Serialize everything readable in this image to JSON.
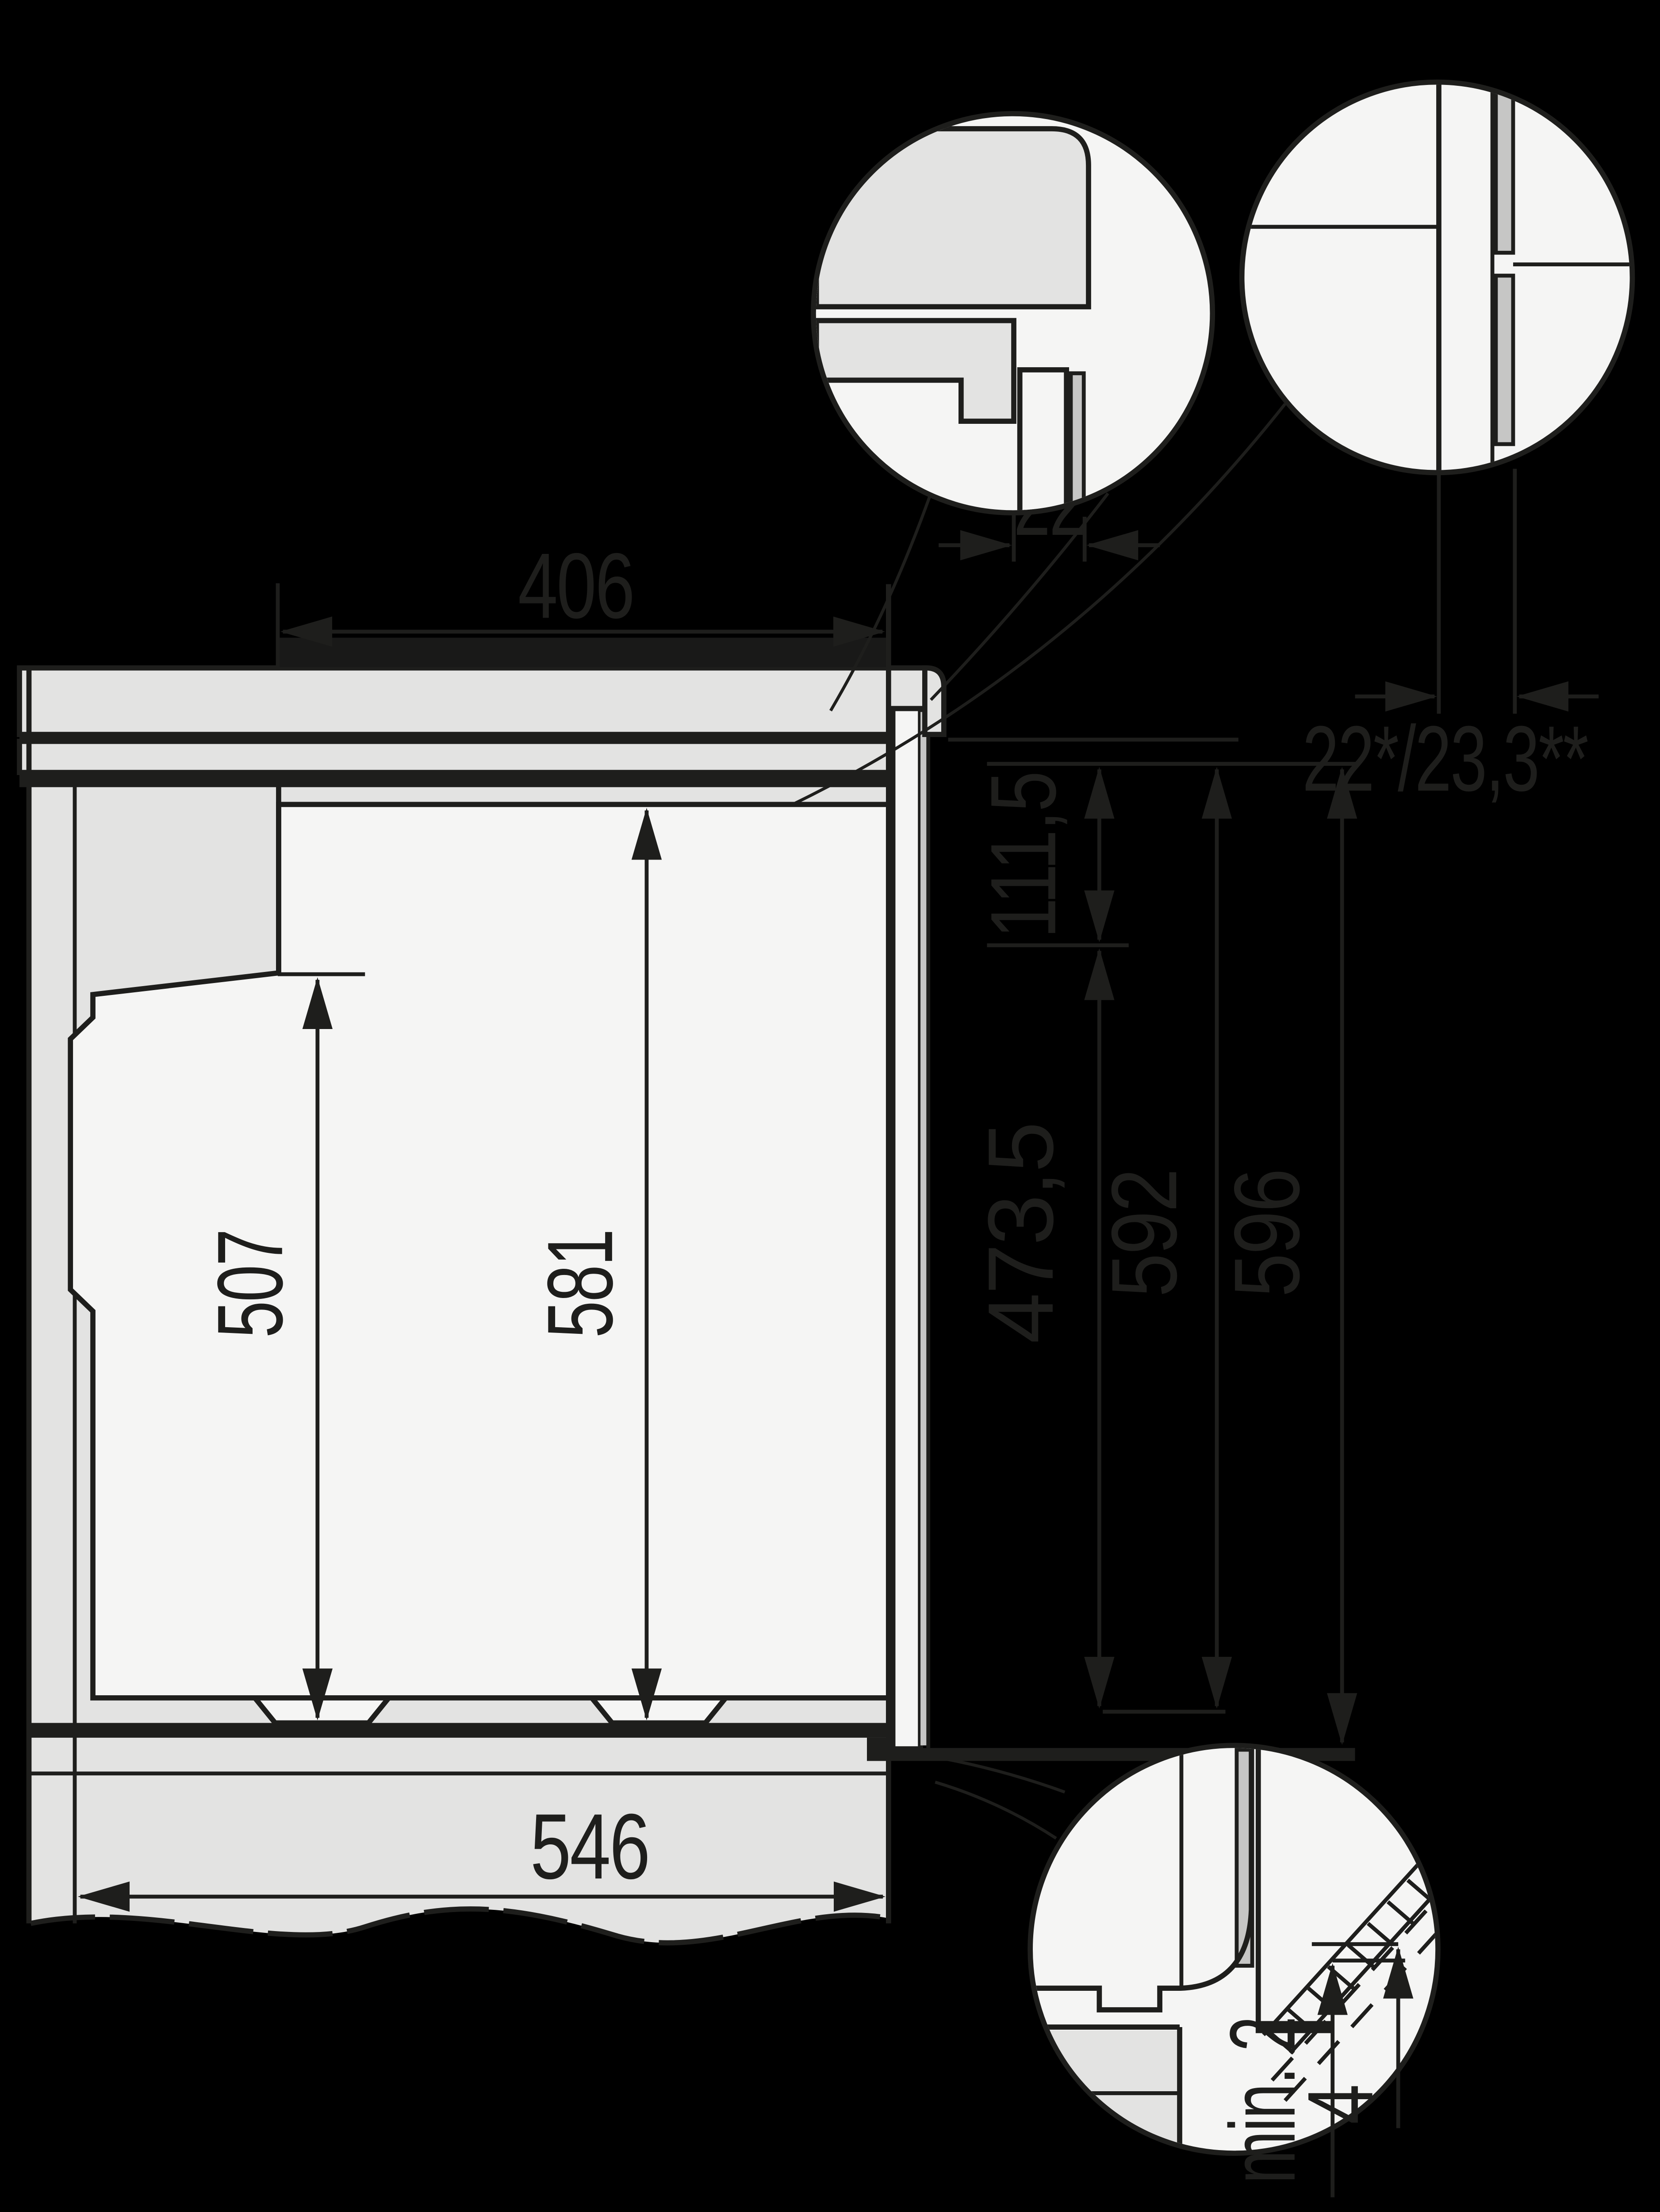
{
  "title": "Built-in oven installation drawing (side section with detail callouts)",
  "units": "mm",
  "colors": {
    "background": "#000000",
    "line": "#1e1e1c",
    "cabinet_gray": "#e3e3e2",
    "appliance_white": "#f5f5f4",
    "glass_gray": "#c6c6c5"
  },
  "labels": {
    "niche_depth": "406",
    "door_projection": "22",
    "front_offset": "22*/23,3**",
    "control_panel_height": "111,5",
    "lower_front_height": "473,5",
    "appliance_height": "592",
    "front_height": "596",
    "rear_clearance": "507",
    "niche_front_height": "581",
    "niche_width": "546",
    "bottom_clearance": "min. 2",
    "bottom_gap": "4"
  }
}
